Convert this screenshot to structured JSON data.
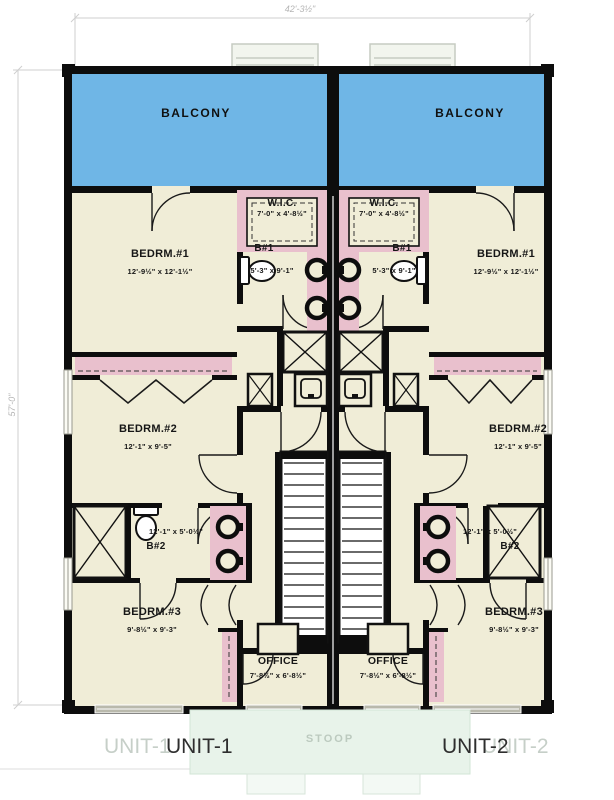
{
  "dimensions": {
    "width_top": "42'-3½\"",
    "height_left": "57'-0\""
  },
  "rooms": {
    "balcony": {
      "label": "BALCONY"
    },
    "bedrm1": {
      "label": "BEDRM.#1",
      "dims": "12'-9½\" x 12'-1½\""
    },
    "bedrm2": {
      "label": "BEDRM.#2",
      "dims": "12'-1\" x 9'-5\""
    },
    "bedrm3": {
      "label": "BEDRM.#3",
      "dims": "9'-8½\" x 9'-3\""
    },
    "wic": {
      "label": "W.I.C.",
      "dims": "7'-0\" x 4'-8½\""
    },
    "bath1": {
      "label": "B#1",
      "dims": "5'-3\" x 9'-1\""
    },
    "bath2": {
      "label": "B#2",
      "dims": "12'-1\" x 5'-0½\""
    },
    "office": {
      "label": "OFFICE",
      "dims": "7'-8½\" x 6'-8½\""
    },
    "stoop": {
      "label": "STOOP"
    }
  },
  "units": {
    "unit1": "UNIT-1",
    "unit2": "UNIT-2"
  },
  "colors": {
    "balcony_blue": "#6fb6e6",
    "floor_cream": "#f0edd7",
    "closet_pink": "#e9c0cd",
    "wall_black": "#0d0d0d",
    "stoop_green": "#e8f3ea",
    "dimension_gray": "#c9c9c9"
  }
}
